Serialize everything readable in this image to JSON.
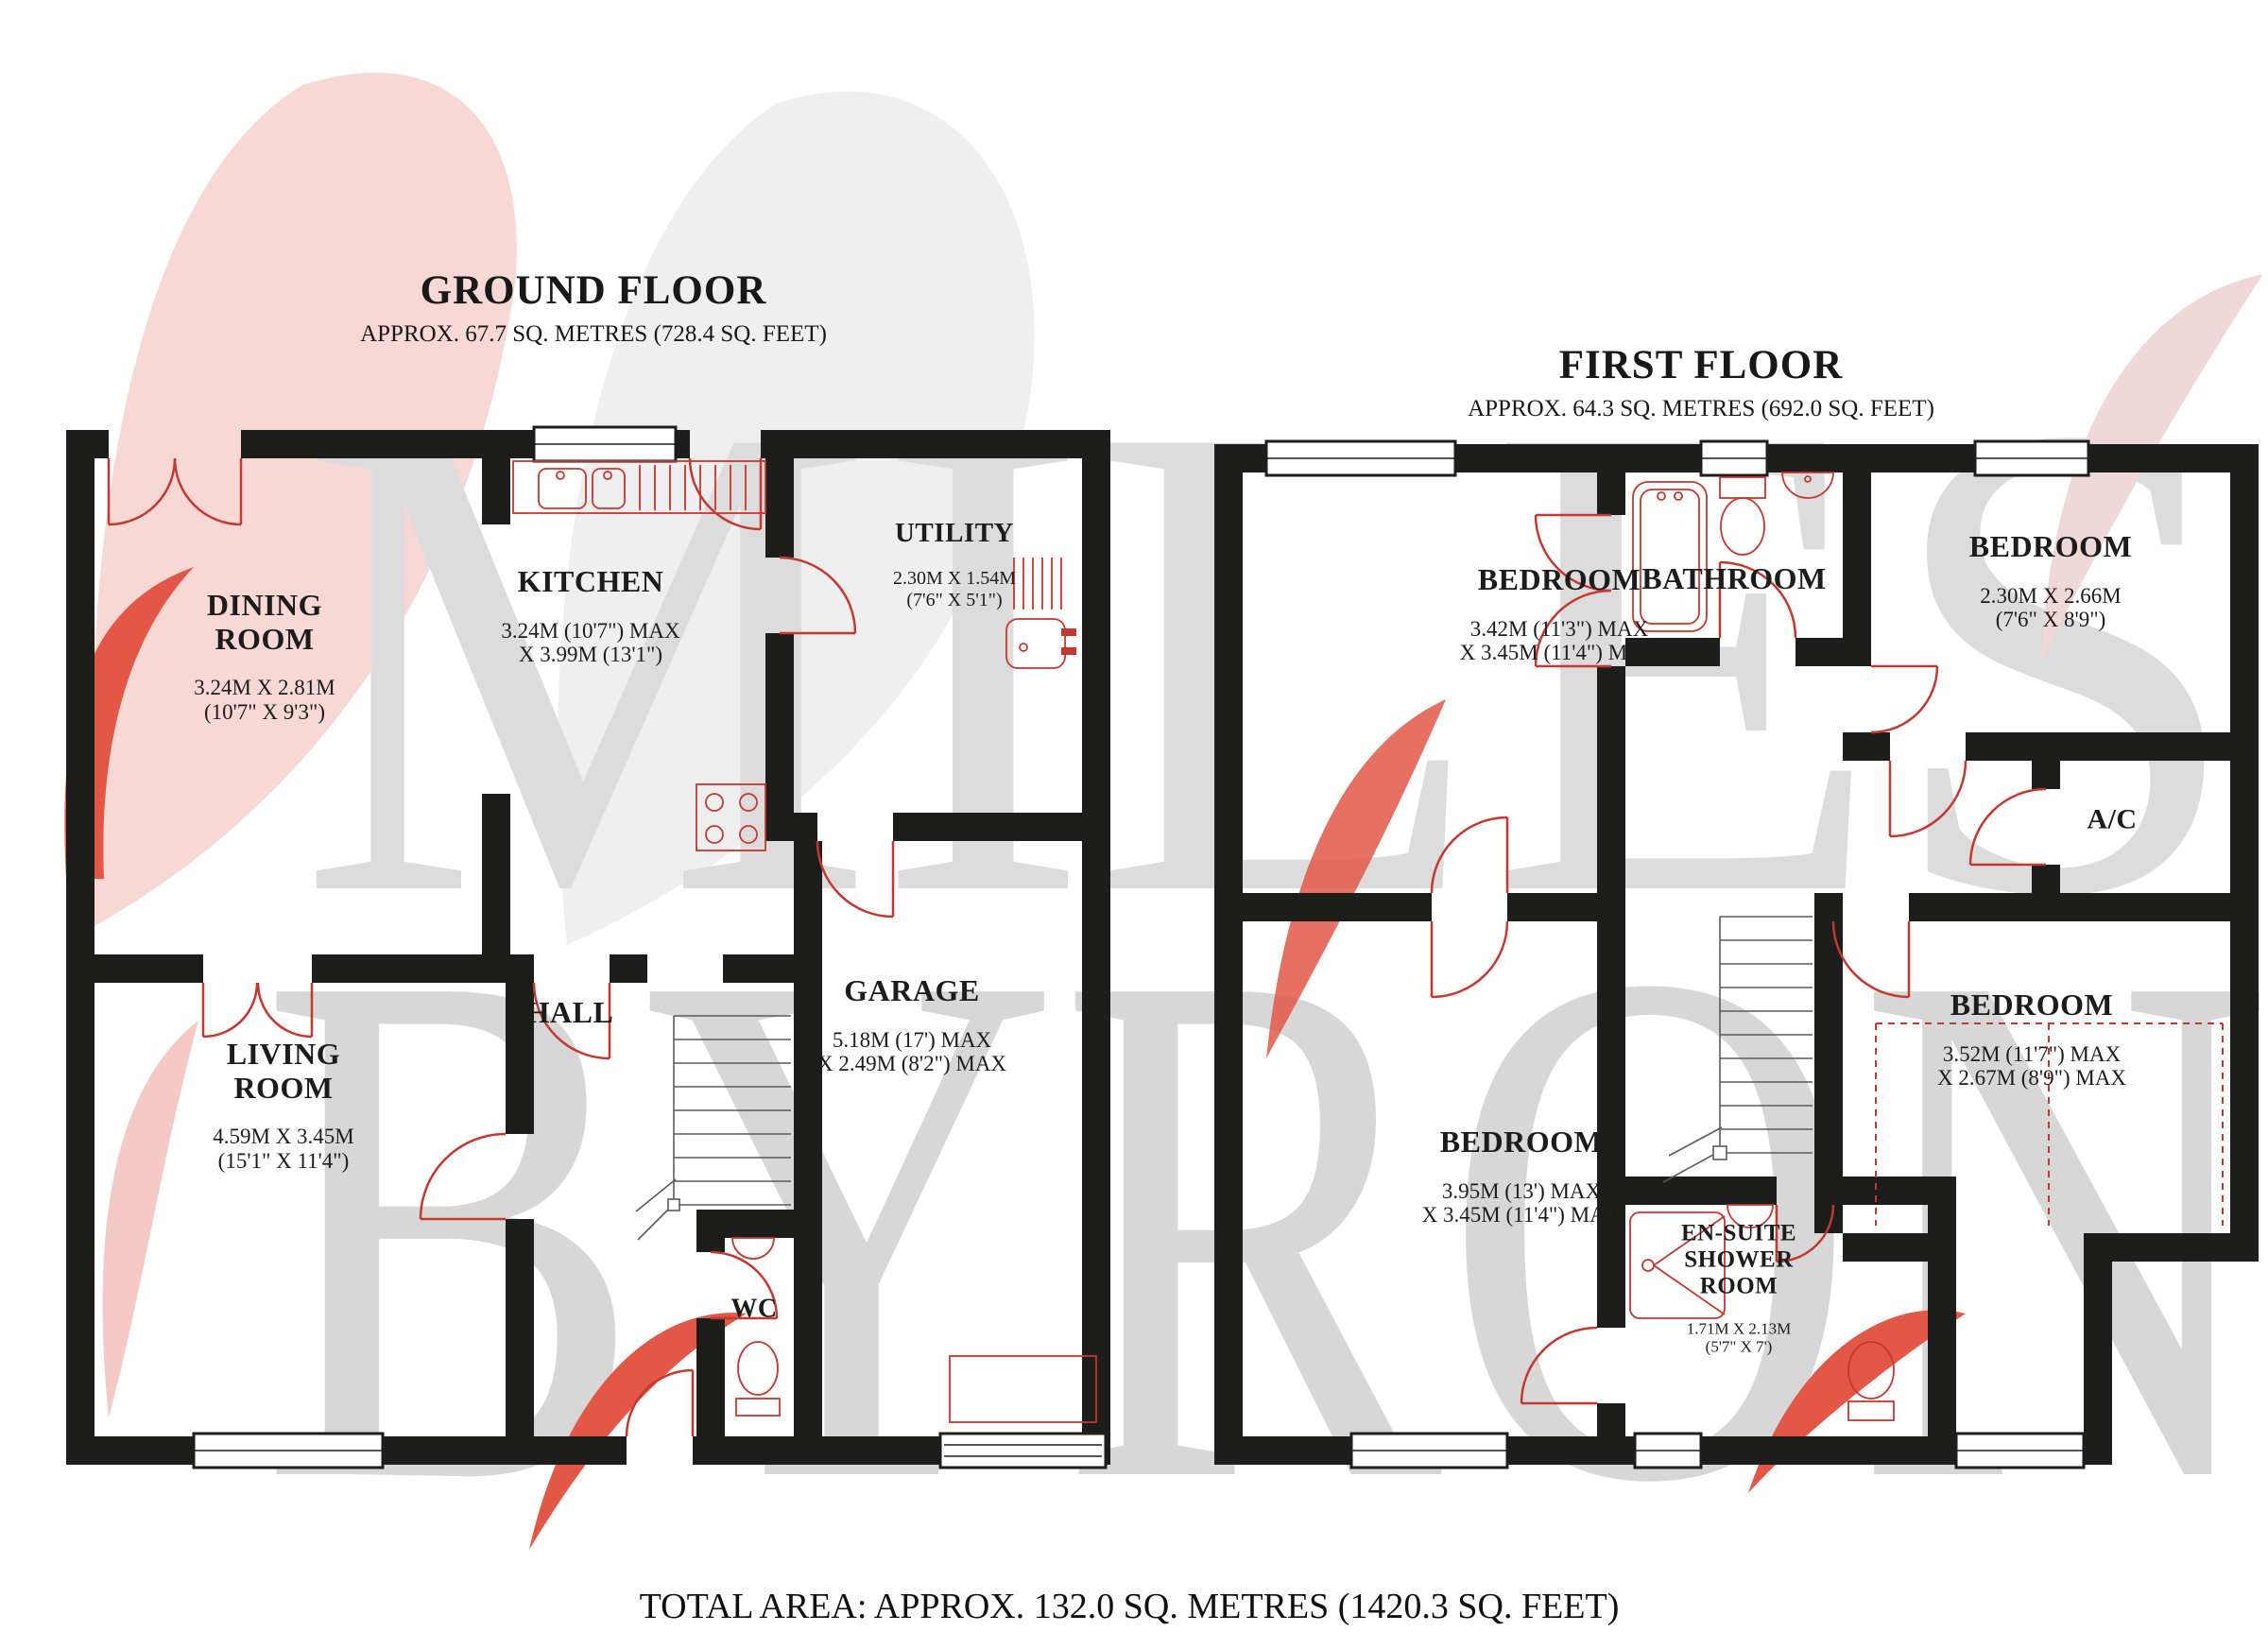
{
  "page": {
    "background": "#ffffff"
  },
  "watermark": {
    "line1": "MILES",
    "line2": "BYRON",
    "letter_color": "#dcdcdc",
    "pink": "#f7d8d5",
    "gray": "#efefef",
    "red": "#e25746"
  },
  "ground_floor": {
    "title": "GROUND FLOOR",
    "subtitle": "APPROX. 67.7 SQ. METRES (728.4 SQ. FEET)",
    "rooms": {
      "dining": {
        "name": "DINING\nROOM",
        "dims": "3.24M X 2.81M\n(10'7\" X 9'3\")"
      },
      "kitchen": {
        "name": "KITCHEN",
        "dims": "3.24M (10'7\") MAX\nX 3.99M (13'1\")"
      },
      "utility": {
        "name": "UTILITY",
        "dims": "2.30M X 1.54M\n(7'6\" X 5'1\")"
      },
      "hall": {
        "name": "HALL"
      },
      "living": {
        "name": "LIVING\nROOM",
        "dims": "4.59M X 3.45M\n(15'1\" X 11'4\")"
      },
      "wc": {
        "name": "WC"
      },
      "garage": {
        "name": "GARAGE",
        "dims": "5.18M (17') MAX\nX 2.49M (8'2\") MAX"
      }
    }
  },
  "first_floor": {
    "title": "FIRST FLOOR",
    "subtitle": "APPROX. 64.3 SQ. METRES (692.0 SQ. FEET)",
    "rooms": {
      "bedroom1": {
        "name": "BEDROOM",
        "dims": "3.42M (11'3\") MAX\nX 3.45M (11'4\") MAX"
      },
      "bathroom": {
        "name": "BATHROOM"
      },
      "bedroom2": {
        "name": "BEDROOM",
        "dims": "2.30M X 2.66M\n(7'6\" X 8'9\")"
      },
      "ac": {
        "name": "A/C"
      },
      "bedroom3": {
        "name": "BEDROOM",
        "dims": "3.52M (11'7\") MAX\nX 2.67M (8'9\") MAX"
      },
      "bedroom4": {
        "name": "BEDROOM",
        "dims": "3.95M (13') MAX\nX 3.45M (11'4\") MAX"
      },
      "ensuite": {
        "name": "EN-SUITE\nSHOWER\nROOM",
        "dims": "1.71M X 2.13M\n(5'7\" X 7')"
      }
    }
  },
  "footer": {
    "total_area": "TOTAL AREA: APPROX. 132.0 SQ. METRES (1420.3 SQ. FEET)"
  },
  "colors": {
    "wall": "#1d1d1b",
    "fixture_red": "#c5382f",
    "text": "#1c1c1c"
  }
}
